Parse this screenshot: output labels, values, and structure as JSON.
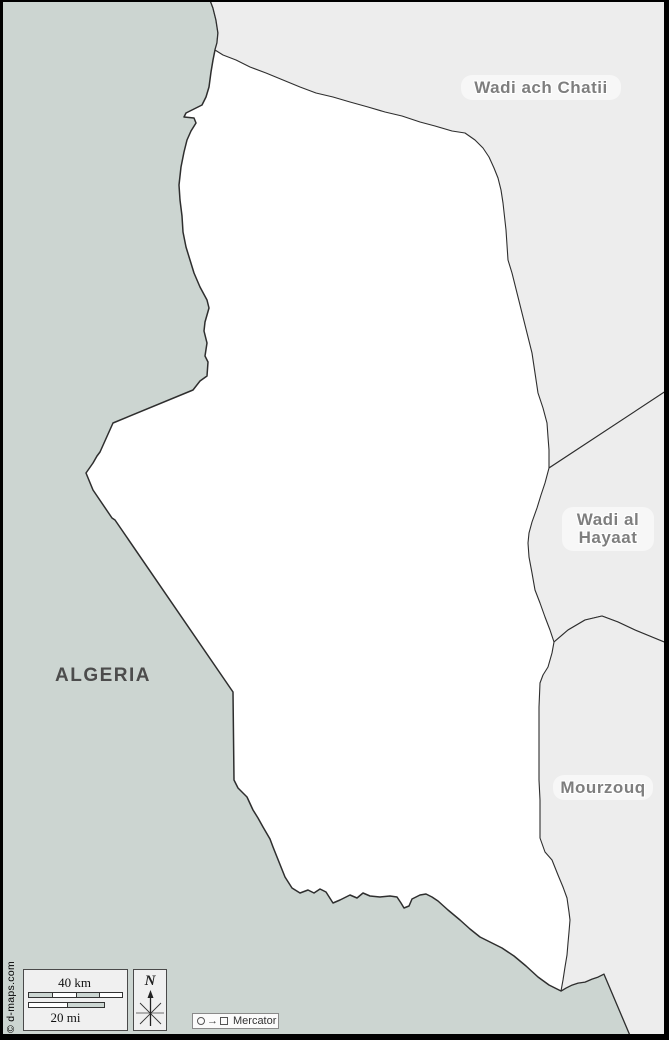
{
  "map": {
    "labels": {
      "algeria": "ALGERIA",
      "wadi_ach_chatii": "Wadi ach Chatii",
      "wadi_al_hayaat_line1": "Wadi al",
      "wadi_al_hayaat_line2": "Hayaat",
      "mourzouq": "Mourzouq"
    },
    "colors": {
      "country_fill": "#ccd5d1",
      "district_fill": "#ededed",
      "focus_fill": "#ffffff",
      "border_line": "#2e2e2e",
      "district_label_gray": "#7e7e7e",
      "country_label_gray": "#4c4c4c"
    }
  },
  "scale_bar": {
    "km_label": "40 km",
    "mi_label": "20 mi"
  },
  "compass": {
    "north_label": "N"
  },
  "projection": {
    "label": "Mercator",
    "arrow_icon": "→"
  },
  "credit": "© d-maps.com"
}
